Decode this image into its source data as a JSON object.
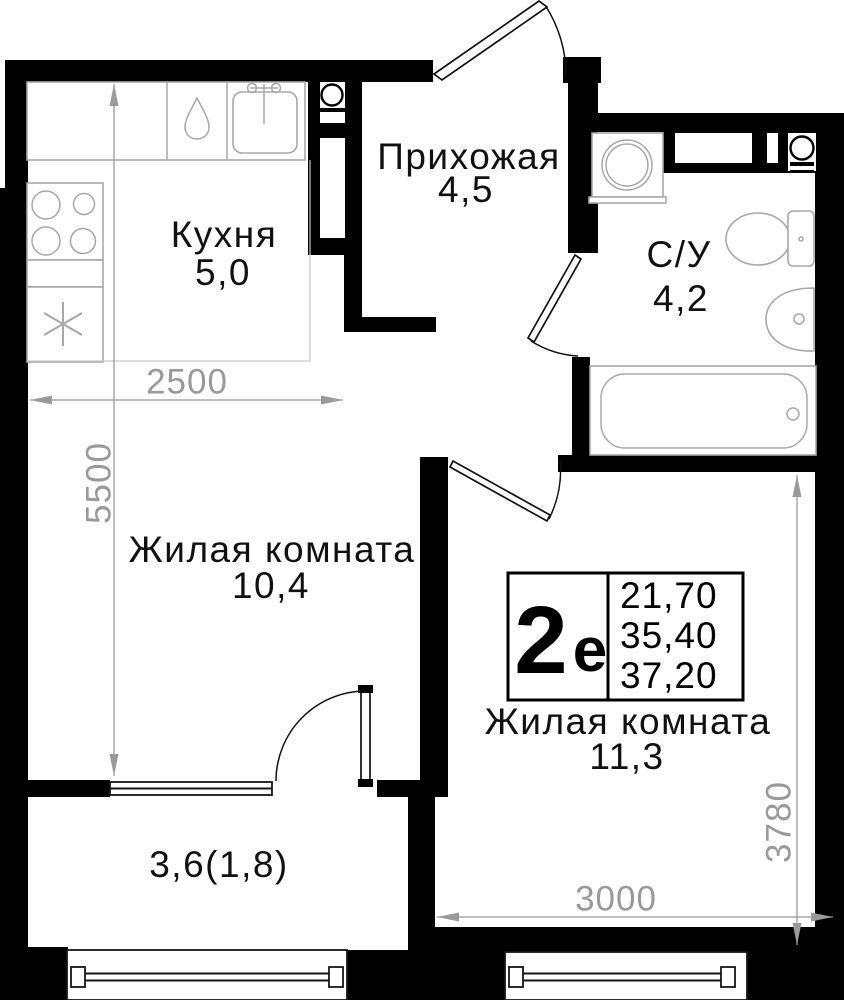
{
  "unit_info": {
    "type_number": "2",
    "type_letter": "е",
    "area_values": [
      "21,70",
      "35,40",
      "37,20"
    ]
  },
  "rooms": {
    "kitchen": {
      "name": "Кухня",
      "area": "5,0"
    },
    "hallway": {
      "name": "Прихожая",
      "area": "4,5"
    },
    "bathroom": {
      "name": "С/У",
      "area": "4,2"
    },
    "living_room_1": {
      "name": "Жилая комната",
      "area": "10,4"
    },
    "living_room_2": {
      "name": "Жилая комната",
      "area": "11,3"
    },
    "balcony": {
      "area": "3,6(1,8)"
    }
  },
  "dimensions_mm": {
    "kitchen_width": "2500",
    "left_wall_height": "5500",
    "room2_width": "3000",
    "room2_height": "3780"
  },
  "colors": {
    "wall": "#000000",
    "dimension": "#9a9a9a",
    "fixture_outline": "#a8a8a8",
    "label_text": "#111111"
  }
}
